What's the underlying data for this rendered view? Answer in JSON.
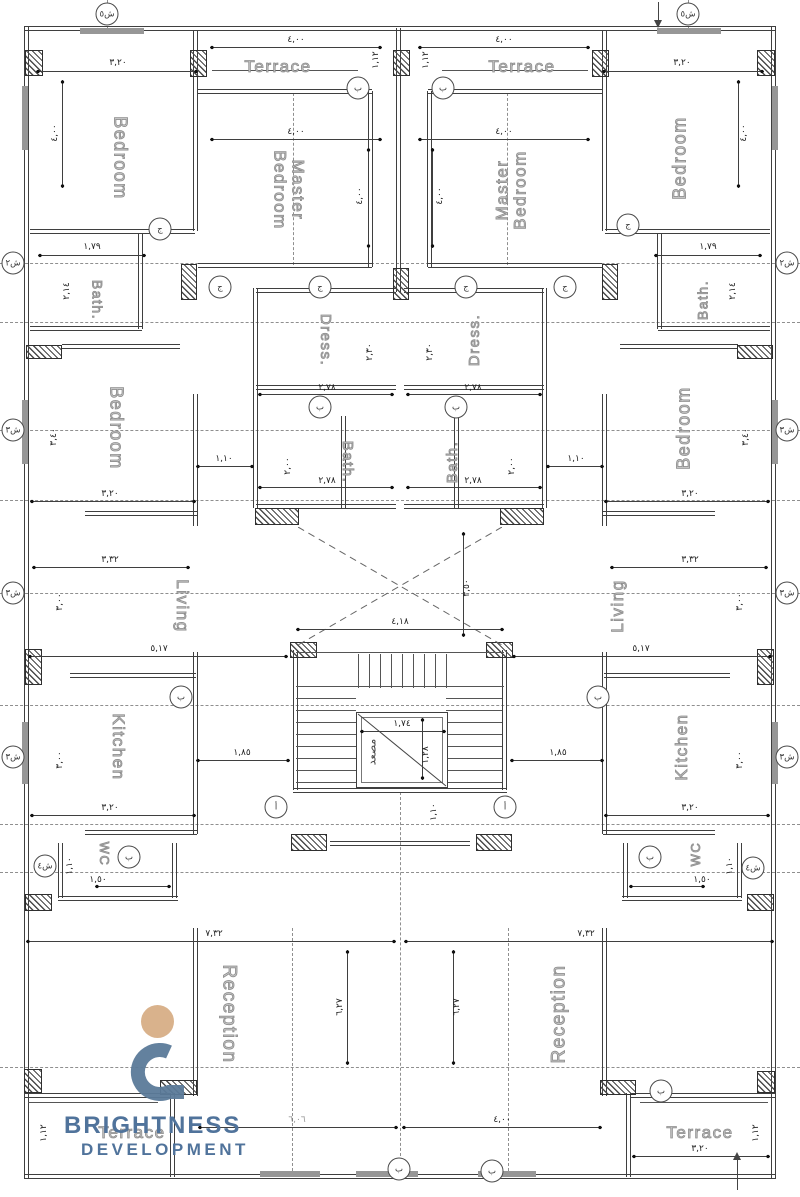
{
  "rooms": {
    "bedroom": "Bedroom",
    "master1": "Master",
    "master2": "Bedroom",
    "terrace": "Terrace",
    "dress": "Dress.",
    "bath": "Bath.",
    "living": "Living",
    "kitchen": "Kitchen",
    "wc": "WC",
    "reception": "Reception",
    "elevator": "مصعد"
  },
  "dims": {
    "d320": "٣,٢٠",
    "d400": "٤,٠٠",
    "d112": "١,١٢",
    "d179": "١,٧٩",
    "d214": "٢,١٤",
    "d230": "٢,٣٠",
    "d278": "٢,٧٨",
    "d200": "٢,٠٠",
    "d110": "١,١٠",
    "d340": "٣,٤٠",
    "d332": "٣,٣٢",
    "d300": "٣,٠٠",
    "d517": "٥,١٧",
    "d185": "١,٨٥",
    "d418": "٤,١٨",
    "d350": "٣,٥٠",
    "d174": "١,٧٤",
    "d128": "١,٢٨",
    "d150": "١,٥٠",
    "d732": "٧,٣٢",
    "d627": "٦,٢٧",
    "d606": "٦,٠٦"
  },
  "axes": {
    "sh5": "ش٥",
    "sh2": "ش٢",
    "sh3": "ش٣",
    "sh4": "ش٤",
    "alef": "أ",
    "ba": "ب",
    "jim": "ج"
  },
  "logo": {
    "line1": "BRIGHTNESS",
    "line2": "DEVELOPMENT"
  },
  "colors": {
    "line": "#3F3F3F",
    "label_outline": "#8D8D8D",
    "logo_text_blue": "#50739B",
    "logo_mark_blue": "#5B7A99",
    "logo_tan": "#D9B28C"
  }
}
